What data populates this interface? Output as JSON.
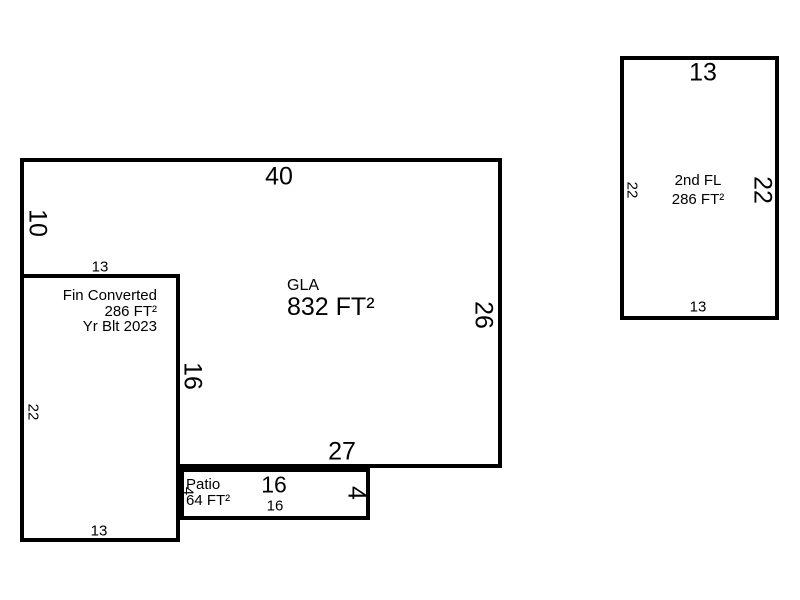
{
  "colors": {
    "wall": "#000000",
    "background": "#ffffff",
    "text": "#000000"
  },
  "sketch": {
    "gla": {
      "label": "GLA",
      "area": "832 FT²",
      "dim_top": "40",
      "dim_left": "10",
      "dim_right": "26",
      "dim_bottom": "27",
      "dim_notch": "16"
    },
    "fin_converted": {
      "line1": "Fin Converted",
      "line2": "286 FT²",
      "line3": "Yr Blt 2023",
      "dim_top": "13",
      "dim_left": "22",
      "dim_bottom": "13"
    },
    "patio": {
      "label": "Patio",
      "area": "64 FT²",
      "dim_top": "16",
      "dim_bottom": "16",
      "dim_left": "4",
      "dim_right": "4"
    },
    "second_floor": {
      "label": "2nd FL",
      "area": "286 FT²",
      "dim_top": "13",
      "dim_right": "22",
      "dim_left": "22",
      "dim_bottom": "13"
    }
  }
}
